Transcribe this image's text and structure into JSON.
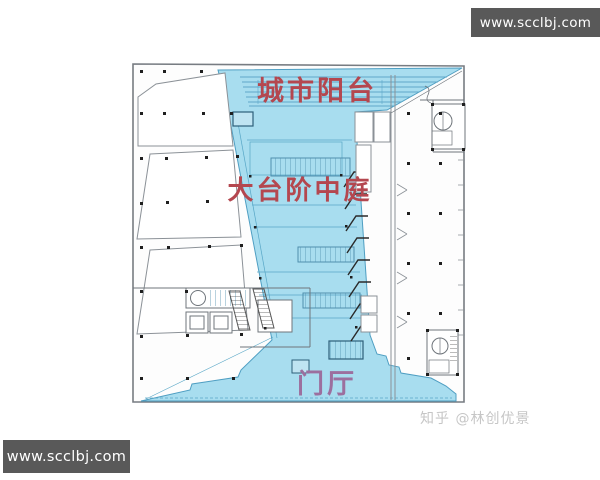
{
  "watermarks": {
    "top_right": "www.scclbj.com",
    "bottom_left": "www.scclbj.com",
    "credit": "知乎 @林创优景"
  },
  "floor_plan": {
    "labels": {
      "city_balcony": "城市阳台",
      "grand_stair_atrium": "大台阶中庭",
      "foyer": "门厅"
    },
    "colors": {
      "highlight_fill": "#a8ddef",
      "highlight_edge": "#4e9ec2",
      "label_red": "#b4474f",
      "label_foyer": "#9c6f9e",
      "plan_line": "#8b9197",
      "column_dot": "#1f1f1f",
      "watermark_bg": "#595959",
      "watermark_text": "#ffffff",
      "credit_text": "#c6c6c6"
    }
  }
}
